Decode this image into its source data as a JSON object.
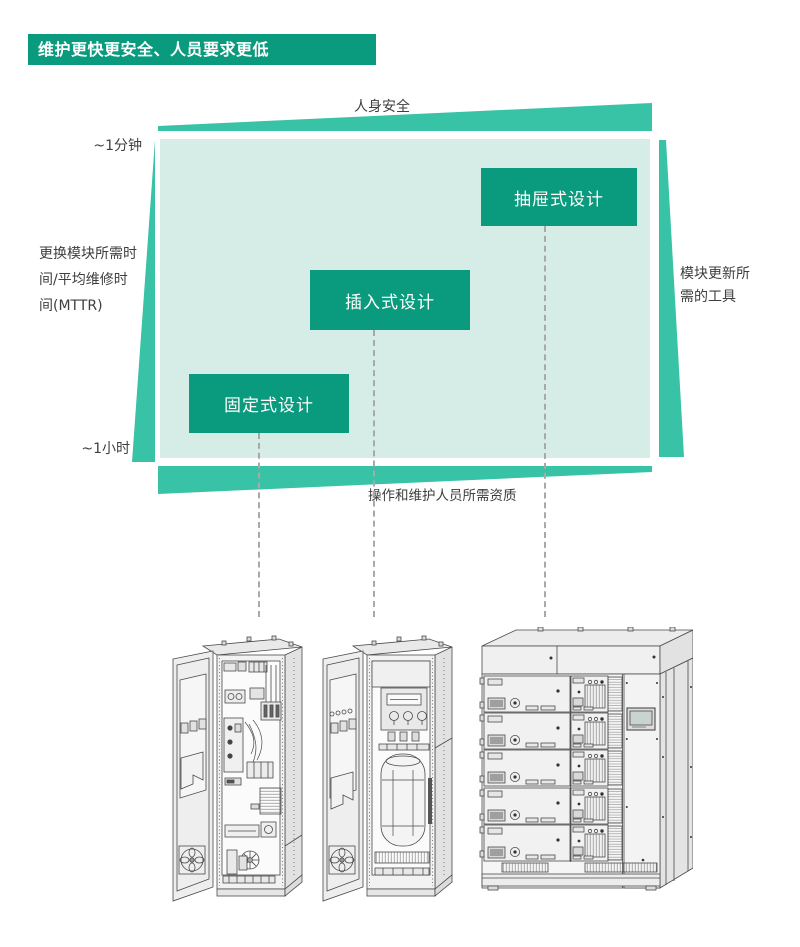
{
  "header": {
    "title": "维护更快更安全、人员要求更低"
  },
  "diagram": {
    "type": "qualitative-positioning-diagram",
    "axis_top": {
      "label": "人身安全",
      "direction": "increases-to-right"
    },
    "axis_left": {
      "label": "更换模块所需时间/平均维修时间(MTTR)",
      "lines": [
        "更换模块所需时",
        "间/平均维修时",
        "间(MTTR)"
      ],
      "tick_top": "~1分钟",
      "tick_bottom": "~1小时",
      "direction": "increases-downward"
    },
    "axis_right": {
      "label": "模块更新所需的工具",
      "lines": [
        "模块更新所",
        "需的工具"
      ],
      "direction": "increases-downward"
    },
    "axis_bottom": {
      "label": "操作和维护人员所需资质",
      "direction": "increases-to-left"
    },
    "designs": [
      {
        "label": "固定式设计",
        "position": "bottom-left"
      },
      {
        "label": "插入式设计",
        "position": "middle"
      },
      {
        "label": "抽屉式设计",
        "position": "top-right"
      }
    ],
    "colors": {
      "accent_dark": "#0a9a7d",
      "accent_wedge": "#38c2a6",
      "plot_background": "#d6ede7",
      "text": "#3e3e3e",
      "connector_dash": "#a9a9a9"
    }
  },
  "illustrations": [
    {
      "name": "fixed-design-cabinet"
    },
    {
      "name": "plug-in-design-cabinet"
    },
    {
      "name": "withdrawable-design-cabinet"
    }
  ]
}
